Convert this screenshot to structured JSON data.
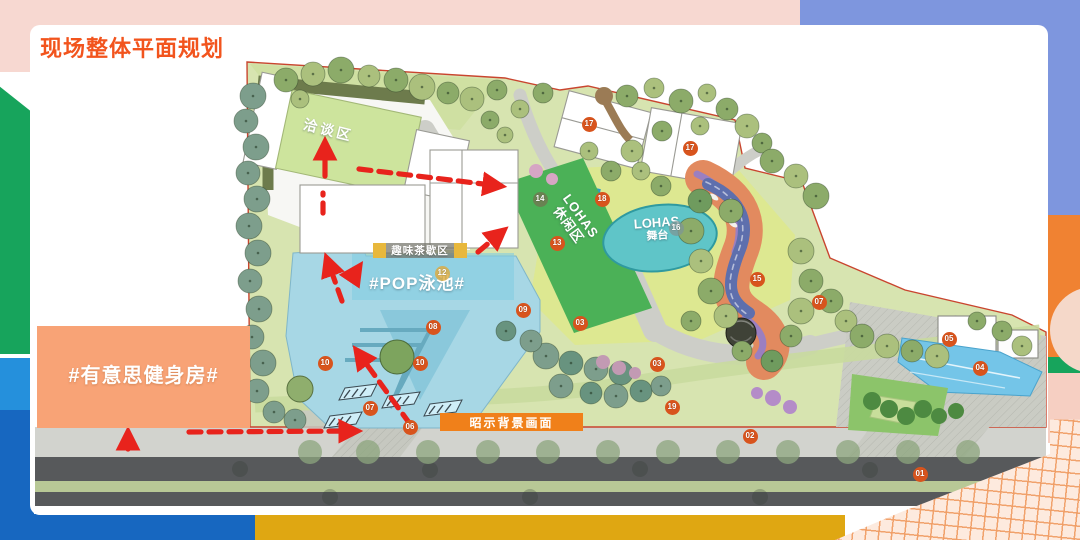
{
  "title": "现场整体平面规划",
  "plan": {
    "labels": {
      "negotiation_area": "洽谈区",
      "tea_break_area": "趣味茶歇区",
      "pop_pool": "#POP泳池#",
      "lohas_lounge_l1": "LOHAS",
      "lohas_lounge_l2": "休闲区",
      "lohas_stage_l1": "LOHAS",
      "lohas_stage_l2": "舞台",
      "gym": "#有意思健身房#",
      "signage_backdrop": "昭示背景画面"
    },
    "markers": [
      {
        "n": "01",
        "x": 920,
        "y": 474
      },
      {
        "n": "02",
        "x": 750,
        "y": 436
      },
      {
        "n": "03",
        "x": 580,
        "y": 323
      },
      {
        "n": "03",
        "x": 657,
        "y": 364
      },
      {
        "n": "04",
        "x": 980,
        "y": 368
      },
      {
        "n": "05",
        "x": 949,
        "y": 339
      },
      {
        "n": "06",
        "x": 410,
        "y": 427
      },
      {
        "n": "07",
        "x": 370,
        "y": 408
      },
      {
        "n": "07",
        "x": 819,
        "y": 302
      },
      {
        "n": "08",
        "x": 433,
        "y": 327
      },
      {
        "n": "09",
        "x": 523,
        "y": 310
      },
      {
        "n": "10",
        "x": 325,
        "y": 363
      },
      {
        "n": "10",
        "x": 420,
        "y": 363
      },
      {
        "n": "12",
        "x": 442,
        "y": 273,
        "variant": "gold"
      },
      {
        "n": "13",
        "x": 557,
        "y": 243
      },
      {
        "n": "14",
        "x": 540,
        "y": 199,
        "variant": "olive"
      },
      {
        "n": "15",
        "x": 757,
        "y": 279
      },
      {
        "n": "16",
        "x": 676,
        "y": 228,
        "variant": "gray"
      },
      {
        "n": "17",
        "x": 589,
        "y": 124
      },
      {
        "n": "17",
        "x": 690,
        "y": 148
      },
      {
        "n": "18",
        "x": 602,
        "y": 199
      },
      {
        "n": "19",
        "x": 672,
        "y": 407
      }
    ]
  },
  "colors": {
    "title": "#f2541d",
    "marker": "#d8541d",
    "marker_gold": "rgba(224,170,60,0.8)",
    "marker_olive": "rgba(115,115,80,0.75)",
    "marker_gray": "rgba(125,150,150,0.75)",
    "arrow": "#e8231c",
    "gym_box": "#f8a376",
    "backdrop_box": "#f0801a",
    "frame_pink": "#f7d8d1",
    "frame_periwinkle": "#7e96de",
    "frame_green": "#17a45c",
    "frame_blue_light": "#2590dc",
    "frame_blue": "#1767c0",
    "frame_gold": "#dfa712",
    "frame_orange": "#f08232"
  }
}
